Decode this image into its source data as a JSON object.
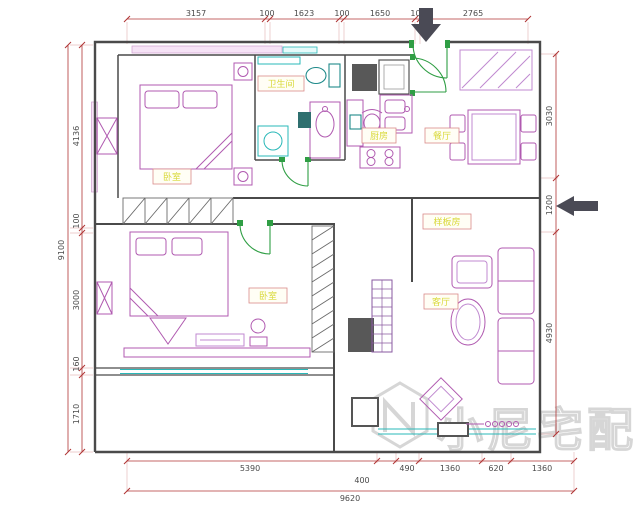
{
  "watermark": {
    "brand": "小尼宅配"
  },
  "rooms": {
    "bedroom1": "卧室",
    "bathroom": "卫生间",
    "kitchen": "厨房",
    "dining": "餐厅",
    "model_room": "样板房",
    "bedroom2": "卧室",
    "living": "客厅"
  },
  "dimensions": {
    "top": [
      "3157",
      "100",
      "1623",
      "100",
      "1650",
      "100",
      "2765"
    ],
    "left_total": "9100",
    "left": [
      "4136",
      "100",
      "3000",
      "160",
      "1710"
    ],
    "right": [
      "3030",
      "1200",
      "4930"
    ],
    "bottom_row": [
      "5390",
      "490",
      "1360",
      "620",
      "1360"
    ],
    "bottom_offset": "400",
    "bottom_total": "9620"
  },
  "colors": {
    "dimension": "#b03535",
    "wall": "#4a4a4a",
    "furniture": "#b05ab0",
    "window": "#2ab8b8",
    "door": "#2f9e44",
    "label_text": "#d9d93a",
    "watermark": "#d6d6d6"
  }
}
